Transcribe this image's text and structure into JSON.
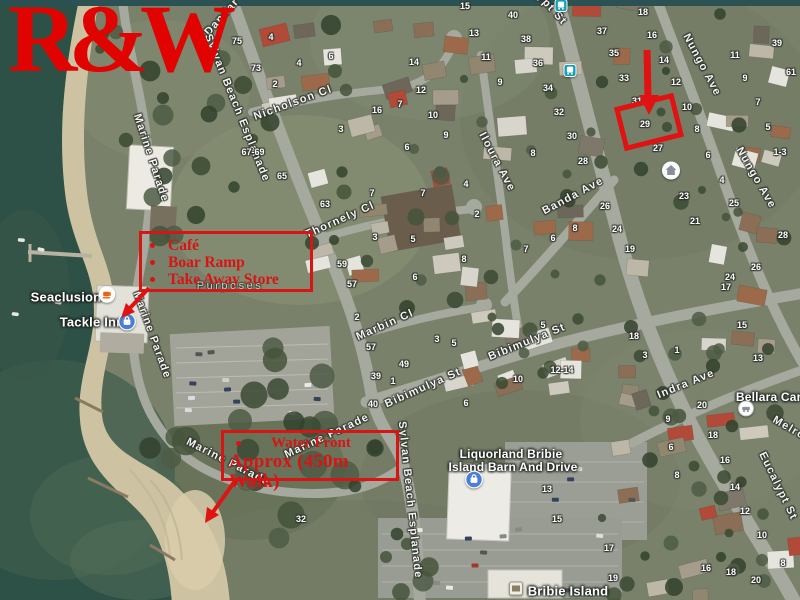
{
  "brand": {
    "logo_text": "R&W",
    "color": "#e10300"
  },
  "annotations": {
    "color": "#d81414",
    "poi_box": {
      "items": [
        "Café",
        "Boar Ramp",
        "Take Away Store"
      ]
    },
    "walk_box": {
      "line1": "Water Front",
      "line2": "Approx (450m Walk)"
    }
  },
  "map": {
    "street_labels": [
      {
        "text": "Dandar",
        "x": 222,
        "y": 17,
        "rot": -48
      },
      {
        "text": "Sylvan Beach Esplanade",
        "x": 237,
        "y": 108,
        "rot": 68
      },
      {
        "text": "Marine Parade",
        "x": 151,
        "y": 158,
        "rot": 72
      },
      {
        "text": "Marine Parade",
        "x": 152,
        "y": 335,
        "rot": 70
      },
      {
        "text": "Marine Parade",
        "x": 228,
        "y": 462,
        "rot": 27
      },
      {
        "text": "Marine Parade",
        "x": 327,
        "y": 436,
        "rot": -25
      },
      {
        "text": "Sylvan Beach Esplanade",
        "x": 410,
        "y": 500,
        "rot": 84
      },
      {
        "text": "Nicholson Cl",
        "x": 293,
        "y": 103,
        "rot": -20
      },
      {
        "text": "Thornely Cl",
        "x": 340,
        "y": 220,
        "rot": -24
      },
      {
        "text": "Marbin Cl",
        "x": 385,
        "y": 325,
        "rot": -24
      },
      {
        "text": "Bibimulya St",
        "x": 423,
        "y": 388,
        "rot": -24
      },
      {
        "text": "Bibimulya St",
        "x": 527,
        "y": 342,
        "rot": -22
      },
      {
        "text": "Iloura Ave",
        "x": 497,
        "y": 162,
        "rot": 62
      },
      {
        "text": "Banda Ave",
        "x": 573,
        "y": 196,
        "rot": -28
      },
      {
        "text": "Eucalypt St",
        "x": 540,
        "y": -4,
        "rot": 48
      },
      {
        "text": "Eucalypt St",
        "x": 778,
        "y": 486,
        "rot": 64
      },
      {
        "text": "Nungo Ave",
        "x": 702,
        "y": 65,
        "rot": 62
      },
      {
        "text": "Nungo Ave",
        "x": 756,
        "y": 178,
        "rot": 60
      },
      {
        "text": "Indra Ave",
        "x": 686,
        "y": 384,
        "rot": -22
      },
      {
        "text": "Melro",
        "x": 789,
        "y": 428,
        "rot": 30
      },
      {
        "text": "Purposes",
        "x": 230,
        "y": 286,
        "rot": 0,
        "zone": true
      }
    ],
    "poi_labels": [
      {
        "text": "Seaclusion",
        "x": 66,
        "y": 297,
        "size": 13
      },
      {
        "text": "Tackle Inn",
        "x": 92,
        "y": 322,
        "size": 13
      },
      {
        "text": "Liquorland Bribie",
        "x": 511,
        "y": 454,
        "size": 12
      },
      {
        "text": "Island Barn And Drive",
        "x": 513,
        "y": 467,
        "size": 12
      },
      {
        "text": "Bellara Carava",
        "x": 779,
        "y": 397,
        "size": 12
      },
      {
        "text": "Bribie Island",
        "x": 568,
        "y": 591,
        "size": 13
      }
    ],
    "icons": [
      {
        "name": "cafe-icon",
        "style": "cafe",
        "x": 107,
        "y": 297
      },
      {
        "name": "store-icon",
        "style": "store",
        "x": 127,
        "y": 324
      },
      {
        "name": "store-icon",
        "style": "store",
        "x": 474,
        "y": 482
      },
      {
        "name": "lodging-icon",
        "style": "white",
        "x": 746,
        "y": 411
      },
      {
        "name": "home-marker-icon",
        "style": "home",
        "x": 671,
        "y": 173
      },
      {
        "name": "bus-stop-icon",
        "style": "bus",
        "x": 561,
        "y": 8
      },
      {
        "name": "bus-stop-icon",
        "style": "bus",
        "x": 570,
        "y": 73
      },
      {
        "name": "shopping-centre-icon",
        "style": "shop",
        "x": 516,
        "y": 591
      }
    ],
    "house_numbers": [
      {
        "n": "75",
        "x": 237,
        "y": 41
      },
      {
        "n": "73",
        "x": 256,
        "y": 68
      },
      {
        "n": "4",
        "x": 271,
        "y": 37
      },
      {
        "n": "4",
        "x": 299,
        "y": 63
      },
      {
        "n": "2",
        "x": 275,
        "y": 84
      },
      {
        "n": "6",
        "x": 331,
        "y": 56
      },
      {
        "n": "3",
        "x": 341,
        "y": 129
      },
      {
        "n": "16",
        "x": 377,
        "y": 110
      },
      {
        "n": "7",
        "x": 400,
        "y": 104
      },
      {
        "n": "14",
        "x": 414,
        "y": 62
      },
      {
        "n": "12",
        "x": 421,
        "y": 90
      },
      {
        "n": "10",
        "x": 433,
        "y": 115
      },
      {
        "n": "6",
        "x": 407,
        "y": 147
      },
      {
        "n": "67-69",
        "x": 253,
        "y": 152
      },
      {
        "n": "65",
        "x": 282,
        "y": 176
      },
      {
        "n": "63",
        "x": 325,
        "y": 204
      },
      {
        "n": "7",
        "x": 372,
        "y": 193
      },
      {
        "n": "4",
        "x": 466,
        "y": 184
      },
      {
        "n": "2",
        "x": 477,
        "y": 214
      },
      {
        "n": "3",
        "x": 375,
        "y": 237
      },
      {
        "n": "5",
        "x": 413,
        "y": 239
      },
      {
        "n": "8",
        "x": 464,
        "y": 259
      },
      {
        "n": "6",
        "x": 415,
        "y": 277
      },
      {
        "n": "59",
        "x": 342,
        "y": 264
      },
      {
        "n": "57",
        "x": 352,
        "y": 284
      },
      {
        "n": "57",
        "x": 371,
        "y": 347
      },
      {
        "n": "49",
        "x": 404,
        "y": 364
      },
      {
        "n": "39",
        "x": 376,
        "y": 376
      },
      {
        "n": "1",
        "x": 393,
        "y": 381
      },
      {
        "n": "2",
        "x": 357,
        "y": 317
      },
      {
        "n": "3",
        "x": 437,
        "y": 339
      },
      {
        "n": "5",
        "x": 454,
        "y": 343
      },
      {
        "n": "5",
        "x": 543,
        "y": 325
      },
      {
        "n": "40",
        "x": 373,
        "y": 404
      },
      {
        "n": "10",
        "x": 518,
        "y": 379
      },
      {
        "n": "12-14",
        "x": 562,
        "y": 370
      },
      {
        "n": "6",
        "x": 466,
        "y": 403
      },
      {
        "n": "32",
        "x": 301,
        "y": 519
      },
      {
        "n": "15",
        "x": 465,
        "y": 6
      },
      {
        "n": "40",
        "x": 513,
        "y": 15
      },
      {
        "n": "13",
        "x": 474,
        "y": 33
      },
      {
        "n": "38",
        "x": 526,
        "y": 39
      },
      {
        "n": "11",
        "x": 486,
        "y": 57
      },
      {
        "n": "36",
        "x": 538,
        "y": 63
      },
      {
        "n": "9",
        "x": 500,
        "y": 82
      },
      {
        "n": "34",
        "x": 548,
        "y": 88
      },
      {
        "n": "32",
        "x": 559,
        "y": 112
      },
      {
        "n": "18",
        "x": 643,
        "y": 12
      },
      {
        "n": "37",
        "x": 602,
        "y": 31
      },
      {
        "n": "35",
        "x": 614,
        "y": 53
      },
      {
        "n": "33",
        "x": 624,
        "y": 78
      },
      {
        "n": "31",
        "x": 637,
        "y": 101
      },
      {
        "n": "29",
        "x": 645,
        "y": 124
      },
      {
        "n": "27",
        "x": 658,
        "y": 148
      },
      {
        "n": "16",
        "x": 652,
        "y": 35
      },
      {
        "n": "14",
        "x": 664,
        "y": 60
      },
      {
        "n": "12",
        "x": 676,
        "y": 82
      },
      {
        "n": "10",
        "x": 687,
        "y": 107
      },
      {
        "n": "8",
        "x": 697,
        "y": 129
      },
      {
        "n": "6",
        "x": 708,
        "y": 155
      },
      {
        "n": "4",
        "x": 722,
        "y": 180
      },
      {
        "n": "39",
        "x": 777,
        "y": 43
      },
      {
        "n": "61",
        "x": 791,
        "y": 72
      },
      {
        "n": "11",
        "x": 735,
        "y": 55
      },
      {
        "n": "9",
        "x": 745,
        "y": 78
      },
      {
        "n": "7",
        "x": 758,
        "y": 102
      },
      {
        "n": "5",
        "x": 768,
        "y": 127
      },
      {
        "n": "1-3",
        "x": 780,
        "y": 152
      },
      {
        "n": "23",
        "x": 684,
        "y": 196
      },
      {
        "n": "25",
        "x": 734,
        "y": 203
      },
      {
        "n": "21",
        "x": 695,
        "y": 221
      },
      {
        "n": "28",
        "x": 783,
        "y": 235
      },
      {
        "n": "26",
        "x": 756,
        "y": 267
      },
      {
        "n": "24",
        "x": 730,
        "y": 277
      },
      {
        "n": "17",
        "x": 726,
        "y": 287
      },
      {
        "n": "15",
        "x": 742,
        "y": 325
      },
      {
        "n": "9",
        "x": 446,
        "y": 135
      },
      {
        "n": "7",
        "x": 423,
        "y": 193
      },
      {
        "n": "8",
        "x": 533,
        "y": 153
      },
      {
        "n": "30",
        "x": 572,
        "y": 136
      },
      {
        "n": "28",
        "x": 583,
        "y": 161
      },
      {
        "n": "26",
        "x": 605,
        "y": 206
      },
      {
        "n": "24",
        "x": 617,
        "y": 229
      },
      {
        "n": "19",
        "x": 630,
        "y": 249
      },
      {
        "n": "8",
        "x": 575,
        "y": 228
      },
      {
        "n": "6",
        "x": 553,
        "y": 238
      },
      {
        "n": "7",
        "x": 526,
        "y": 249
      },
      {
        "n": "18",
        "x": 634,
        "y": 336
      },
      {
        "n": "3",
        "x": 645,
        "y": 355
      },
      {
        "n": "1",
        "x": 677,
        "y": 350
      },
      {
        "n": "13",
        "x": 758,
        "y": 358
      },
      {
        "n": "20",
        "x": 702,
        "y": 405
      },
      {
        "n": "9",
        "x": 668,
        "y": 419
      },
      {
        "n": "6",
        "x": 671,
        "y": 447
      },
      {
        "n": "8",
        "x": 677,
        "y": 475
      },
      {
        "n": "16",
        "x": 725,
        "y": 460
      },
      {
        "n": "18",
        "x": 713,
        "y": 435
      },
      {
        "n": "14",
        "x": 735,
        "y": 487
      },
      {
        "n": "12",
        "x": 745,
        "y": 511
      },
      {
        "n": "10",
        "x": 762,
        "y": 535
      },
      {
        "n": "8",
        "x": 783,
        "y": 563
      },
      {
        "n": "16",
        "x": 706,
        "y": 568
      },
      {
        "n": "18",
        "x": 731,
        "y": 572
      },
      {
        "n": "20",
        "x": 756,
        "y": 580
      },
      {
        "n": "13",
        "x": 547,
        "y": 489
      },
      {
        "n": "15",
        "x": 557,
        "y": 519
      },
      {
        "n": "17",
        "x": 609,
        "y": 548
      },
      {
        "n": "19",
        "x": 613,
        "y": 578
      }
    ]
  }
}
